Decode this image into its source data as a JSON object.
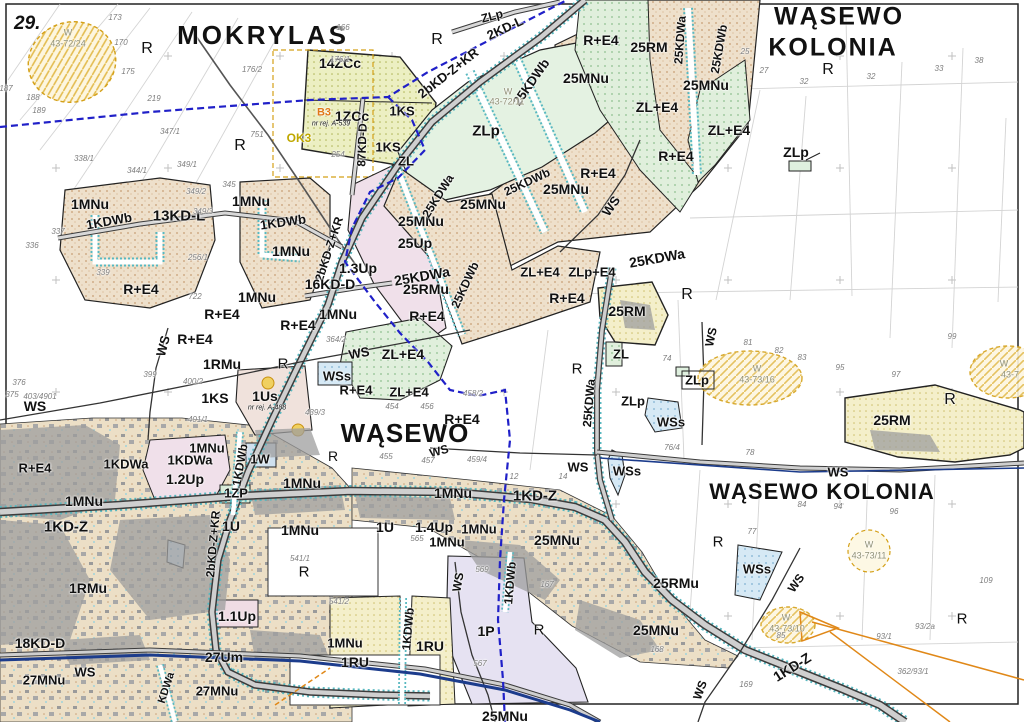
{
  "sheet": {
    "number": "29."
  },
  "colors": {
    "black": "#111111",
    "gray": "#7d7d7d",
    "site": "#8f8f74",
    "orange": "#e07818",
    "olive": "#bfa800",
    "tan_zone": "#eee0cb",
    "green_zone": "#e0efdc",
    "yellow_zone": "#f4efca",
    "blue_zone": "#d6e9f5",
    "water_navy": "#1c3c8c",
    "boundary_blue": "#2020c8",
    "teal_edge": "#58b8c0",
    "road_gray": "#cfcfcf"
  },
  "labels": [
    {
      "t": "MOKRYLAS",
      "x": 263,
      "y": 35,
      "s": 26,
      "ls": 3,
      "k": "place"
    },
    {
      "t": "WĄSEWO",
      "x": 839,
      "y": 17,
      "s": 25,
      "ls": 2,
      "k": "place"
    },
    {
      "t": "KOLONIA",
      "x": 833,
      "y": 48,
      "s": 25,
      "ls": 2,
      "k": "place"
    },
    {
      "t": "WĄSEWO",
      "x": 405,
      "y": 433,
      "s": 26,
      "ls": 1,
      "k": "place"
    },
    {
      "t": "WĄSEWO KOLONIA",
      "x": 822,
      "y": 492,
      "s": 22,
      "ls": 1,
      "k": "place"
    },
    {
      "t": "14ZCc",
      "x": 340,
      "y": 63,
      "s": 14
    },
    {
      "t": "1ZCc",
      "x": 352,
      "y": 116,
      "s": 14
    },
    {
      "t": "B3",
      "x": 324,
      "y": 113,
      "s": 11,
      "c": "orange"
    },
    {
      "t": "OK3",
      "x": 299,
      "y": 138,
      "s": 12,
      "c": "olive"
    },
    {
      "t": "nr rej. A-539",
      "x": 331,
      "y": 124,
      "s": 7,
      "w": "n",
      "i": true
    },
    {
      "t": "nr rej. A-488",
      "x": 267,
      "y": 408,
      "s": 7,
      "w": "n",
      "i": true
    },
    {
      "t": "1KS",
      "x": 402,
      "y": 111,
      "s": 13
    },
    {
      "t": "1KS",
      "x": 388,
      "y": 147,
      "s": 13
    },
    {
      "t": "87KD-D",
      "x": 362,
      "y": 145,
      "s": 12,
      "r": -88
    },
    {
      "t": "ZL",
      "x": 406,
      "y": 161,
      "s": 13
    },
    {
      "t": "ZLp",
      "x": 486,
      "y": 131,
      "s": 15
    },
    {
      "t": "2KD-L",
      "x": 505,
      "y": 28,
      "s": 13,
      "r": -25
    },
    {
      "t": "ZLp",
      "x": 492,
      "y": 16,
      "s": 12,
      "r": -15
    },
    {
      "t": "2bKD-Z+KR",
      "x": 448,
      "y": 73,
      "s": 13,
      "r": -38
    },
    {
      "t": "25KDWb",
      "x": 531,
      "y": 82,
      "s": 13,
      "r": -55
    },
    {
      "t": "25MNu",
      "x": 586,
      "y": 78,
      "s": 14
    },
    {
      "t": "R",
      "x": 437,
      "y": 40,
      "s": 16,
      "w": "n"
    },
    {
      "t": "R+E4",
      "x": 601,
      "y": 40,
      "s": 14
    },
    {
      "t": "25RM",
      "x": 649,
      "y": 47,
      "s": 14
    },
    {
      "t": "25KDWa",
      "x": 680,
      "y": 40,
      "s": 12,
      "r": -86
    },
    {
      "t": "25KDWb",
      "x": 719,
      "y": 49,
      "s": 12,
      "r": -80
    },
    {
      "t": "25MNu",
      "x": 706,
      "y": 85,
      "s": 14
    },
    {
      "t": "ZL+E4",
      "x": 657,
      "y": 107,
      "s": 14
    },
    {
      "t": "ZL+E4",
      "x": 729,
      "y": 130,
      "s": 14
    },
    {
      "t": "R+E4",
      "x": 676,
      "y": 156,
      "s": 14
    },
    {
      "t": "ZLp",
      "x": 796,
      "y": 152,
      "s": 14
    },
    {
      "t": "R",
      "x": 147,
      "y": 49,
      "s": 16,
      "w": "n"
    },
    {
      "t": "R",
      "x": 240,
      "y": 146,
      "s": 16,
      "w": "n"
    },
    {
      "t": "R",
      "x": 828,
      "y": 70,
      "s": 16,
      "w": "n"
    },
    {
      "t": "1MNu",
      "x": 90,
      "y": 204,
      "s": 14
    },
    {
      "t": "1KDWb",
      "x": 109,
      "y": 221,
      "s": 13,
      "r": -10
    },
    {
      "t": "13KD-L",
      "x": 179,
      "y": 216,
      "s": 15
    },
    {
      "t": "1MNu",
      "x": 251,
      "y": 201,
      "s": 14
    },
    {
      "t": "1KDWb",
      "x": 283,
      "y": 222,
      "s": 13,
      "r": -8
    },
    {
      "t": "1MNu",
      "x": 291,
      "y": 251,
      "s": 14
    },
    {
      "t": "2bKD-Z+KR",
      "x": 329,
      "y": 249,
      "s": 12,
      "r": -72
    },
    {
      "t": "1.3Up",
      "x": 358,
      "y": 268,
      "s": 14
    },
    {
      "t": "16KD-D",
      "x": 330,
      "y": 284,
      "s": 14
    },
    {
      "t": "1MNu",
      "x": 257,
      "y": 297,
      "s": 14
    },
    {
      "t": "1MNu",
      "x": 338,
      "y": 314,
      "s": 14
    },
    {
      "t": "R+E4",
      "x": 141,
      "y": 289,
      "s": 14
    },
    {
      "t": "R+E4",
      "x": 222,
      "y": 314,
      "s": 14
    },
    {
      "t": "R+E4",
      "x": 298,
      "y": 325,
      "s": 14
    },
    {
      "t": "R+E4",
      "x": 195,
      "y": 339,
      "s": 14
    },
    {
      "t": "WS",
      "x": 163,
      "y": 346,
      "s": 13,
      "r": -75
    },
    {
      "t": "25MNu",
      "x": 421,
      "y": 221,
      "s": 14
    },
    {
      "t": "25MNu",
      "x": 483,
      "y": 204,
      "s": 14
    },
    {
      "t": "25MNu",
      "x": 566,
      "y": 189,
      "s": 14
    },
    {
      "t": "25Up",
      "x": 415,
      "y": 243,
      "s": 14
    },
    {
      "t": "25KDWa",
      "x": 438,
      "y": 196,
      "s": 12,
      "r": -58
    },
    {
      "t": "25KDWa",
      "x": 422,
      "y": 276,
      "s": 14,
      "r": -10
    },
    {
      "t": "25RMu",
      "x": 426,
      "y": 289,
      "s": 14
    },
    {
      "t": "25KDWb",
      "x": 465,
      "y": 285,
      "s": 12,
      "r": -65
    },
    {
      "t": "25KDWb",
      "x": 527,
      "y": 182,
      "s": 12,
      "r": -25
    },
    {
      "t": "R+E4",
      "x": 427,
      "y": 316,
      "s": 14
    },
    {
      "t": "R+E4",
      "x": 598,
      "y": 173,
      "s": 14
    },
    {
      "t": "WS",
      "x": 611,
      "y": 206,
      "s": 13,
      "r": -55
    },
    {
      "t": "25KDWa",
      "x": 657,
      "y": 258,
      "s": 14,
      "r": -10
    },
    {
      "t": "ZL+E4",
      "x": 540,
      "y": 272,
      "s": 13
    },
    {
      "t": "ZLp+E4",
      "x": 592,
      "y": 272,
      "s": 13
    },
    {
      "t": "R+E4",
      "x": 567,
      "y": 298,
      "s": 14
    },
    {
      "t": "25RM",
      "x": 627,
      "y": 311,
      "s": 14
    },
    {
      "t": "R",
      "x": 687,
      "y": 295,
      "s": 16,
      "w": "n"
    },
    {
      "t": "ZL",
      "x": 621,
      "y": 354,
      "s": 13
    },
    {
      "t": "R",
      "x": 577,
      "y": 369,
      "s": 15,
      "w": "n"
    },
    {
      "t": "ZLp",
      "x": 697,
      "y": 380,
      "s": 13
    },
    {
      "t": "ZLp",
      "x": 633,
      "y": 401,
      "s": 13
    },
    {
      "t": "WS",
      "x": 711,
      "y": 337,
      "s": 12,
      "r": -78
    },
    {
      "t": "1RMu",
      "x": 222,
      "y": 364,
      "s": 14
    },
    {
      "t": "R",
      "x": 283,
      "y": 364,
      "s": 15,
      "w": "n"
    },
    {
      "t": "WS",
      "x": 359,
      "y": 353,
      "s": 13,
      "r": -10
    },
    {
      "t": "ZL+E4",
      "x": 403,
      "y": 354,
      "s": 14
    },
    {
      "t": "WSs",
      "x": 337,
      "y": 376,
      "s": 13
    },
    {
      "t": "R+E4",
      "x": 356,
      "y": 390,
      "s": 13
    },
    {
      "t": "ZL+E4",
      "x": 409,
      "y": 392,
      "s": 13
    },
    {
      "t": "1KS",
      "x": 215,
      "y": 398,
      "s": 14
    },
    {
      "t": "1Us",
      "x": 265,
      "y": 396,
      "s": 14
    },
    {
      "t": "WS",
      "x": 35,
      "y": 406,
      "s": 14
    },
    {
      "t": "R+E4",
      "x": 35,
      "y": 468,
      "s": 13
    },
    {
      "t": "R+E4",
      "x": 462,
      "y": 419,
      "s": 14
    },
    {
      "t": "WS",
      "x": 439,
      "y": 451,
      "s": 12,
      "r": -15
    },
    {
      "t": "1MNu",
      "x": 84,
      "y": 501,
      "s": 14
    },
    {
      "t": "1KD-Z",
      "x": 66,
      "y": 527,
      "s": 15
    },
    {
      "t": "1KDWa",
      "x": 126,
      "y": 464,
      "s": 13
    },
    {
      "t": "1KDWa",
      "x": 190,
      "y": 460,
      "s": 13
    },
    {
      "t": "1.2Up",
      "x": 185,
      "y": 479,
      "s": 14
    },
    {
      "t": "1MNu",
      "x": 207,
      "y": 448,
      "s": 13
    },
    {
      "t": "1W",
      "x": 260,
      "y": 459,
      "s": 13
    },
    {
      "t": "1KDWb",
      "x": 240,
      "y": 465,
      "s": 12,
      "r": -80
    },
    {
      "t": "1ZP",
      "x": 236,
      "y": 493,
      "s": 13
    },
    {
      "t": "2bKD-Z+KR",
      "x": 213,
      "y": 544,
      "s": 12,
      "r": -85
    },
    {
      "t": "1U",
      "x": 231,
      "y": 526,
      "s": 14
    },
    {
      "t": "1MNu",
      "x": 302,
      "y": 483,
      "s": 14
    },
    {
      "t": "1MNu",
      "x": 300,
      "y": 530,
      "s": 14
    },
    {
      "t": "R",
      "x": 333,
      "y": 456,
      "s": 14,
      "w": "n"
    },
    {
      "t": "R",
      "x": 304,
      "y": 572,
      "s": 15,
      "w": "n"
    },
    {
      "t": "1MNu",
      "x": 453,
      "y": 493,
      "s": 14
    },
    {
      "t": "1KD-Z",
      "x": 535,
      "y": 496,
      "s": 15
    },
    {
      "t": "WS",
      "x": 578,
      "y": 467,
      "s": 13
    },
    {
      "t": "WSs",
      "x": 627,
      "y": 471,
      "s": 13
    },
    {
      "t": "WSs",
      "x": 671,
      "y": 422,
      "s": 13
    },
    {
      "t": "25KDWa",
      "x": 589,
      "y": 403,
      "s": 12,
      "r": -85
    },
    {
      "t": "1U",
      "x": 385,
      "y": 527,
      "s": 14
    },
    {
      "t": "1.4Up",
      "x": 434,
      "y": 527,
      "s": 14
    },
    {
      "t": "1MNu",
      "x": 479,
      "y": 529,
      "s": 13
    },
    {
      "t": "1MNu",
      "x": 447,
      "y": 542,
      "s": 13
    },
    {
      "t": "25MNu",
      "x": 557,
      "y": 540,
      "s": 14
    },
    {
      "t": "1KDWb",
      "x": 510,
      "y": 583,
      "s": 12,
      "r": -85
    },
    {
      "t": "WS",
      "x": 458,
      "y": 582,
      "s": 12,
      "r": -80
    },
    {
      "t": "1KDWb",
      "x": 408,
      "y": 629,
      "s": 12,
      "r": -85
    },
    {
      "t": "1P",
      "x": 486,
      "y": 631,
      "s": 14
    },
    {
      "t": "R",
      "x": 539,
      "y": 630,
      "s": 15,
      "w": "n"
    },
    {
      "t": "1RU",
      "x": 430,
      "y": 646,
      "s": 14
    },
    {
      "t": "1RU",
      "x": 355,
      "y": 662,
      "s": 14
    },
    {
      "t": "1MNu",
      "x": 345,
      "y": 643,
      "s": 13
    },
    {
      "t": "25MNu",
      "x": 505,
      "y": 716,
      "s": 14
    },
    {
      "t": "25RMu",
      "x": 676,
      "y": 583,
      "s": 14
    },
    {
      "t": "25MNu",
      "x": 656,
      "y": 630,
      "s": 14
    },
    {
      "t": "WSs",
      "x": 757,
      "y": 569,
      "s": 13
    },
    {
      "t": "WS",
      "x": 796,
      "y": 583,
      "s": 12,
      "r": -55
    },
    {
      "t": "R",
      "x": 718,
      "y": 542,
      "s": 15,
      "w": "n"
    },
    {
      "t": "R",
      "x": 962,
      "y": 619,
      "s": 15,
      "w": "n"
    },
    {
      "t": "R",
      "x": 950,
      "y": 400,
      "s": 16,
      "w": "n"
    },
    {
      "t": "25RM",
      "x": 892,
      "y": 420,
      "s": 14
    },
    {
      "t": "WS",
      "x": 838,
      "y": 472,
      "s": 13
    },
    {
      "t": "1KD-Z",
      "x": 792,
      "y": 667,
      "s": 14,
      "r": -32
    },
    {
      "t": "WS",
      "x": 700,
      "y": 690,
      "s": 12,
      "r": -70
    },
    {
      "t": "18KD-D",
      "x": 40,
      "y": 643,
      "s": 14
    },
    {
      "t": "27Um",
      "x": 224,
      "y": 657,
      "s": 14
    },
    {
      "t": "WS",
      "x": 85,
      "y": 672,
      "s": 13
    },
    {
      "t": "27MNu",
      "x": 44,
      "y": 680,
      "s": 13
    },
    {
      "t": "27MNu",
      "x": 217,
      "y": 691,
      "s": 13
    },
    {
      "t": "KDWa",
      "x": 167,
      "y": 688,
      "s": 11,
      "r": -72
    },
    {
      "t": "1RMu",
      "x": 88,
      "y": 588,
      "s": 14
    },
    {
      "t": "1.1Up",
      "x": 237,
      "y": 616,
      "s": 14
    },
    {
      "t": "W",
      "x": 68,
      "y": 33,
      "s": 9,
      "w": "n",
      "c": "site",
      "k": "site"
    },
    {
      "t": "43-72/24",
      "x": 68,
      "y": 44,
      "s": 9,
      "w": "n",
      "c": "site",
      "k": "site"
    },
    {
      "t": "W",
      "x": 508,
      "y": 92,
      "s": 9,
      "w": "n",
      "c": "site",
      "k": "site"
    },
    {
      "t": "43-72/11",
      "x": 507,
      "y": 102,
      "s": 9,
      "w": "n",
      "c": "site",
      "k": "site"
    },
    {
      "t": "W",
      "x": 757,
      "y": 369,
      "s": 9,
      "w": "n",
      "c": "site",
      "k": "site"
    },
    {
      "t": "43-73/16",
      "x": 757,
      "y": 380,
      "s": 9,
      "w": "n",
      "c": "site",
      "k": "site"
    },
    {
      "t": "W",
      "x": 869,
      "y": 545,
      "s": 9,
      "w": "n",
      "c": "site",
      "k": "site"
    },
    {
      "t": "43-73/11",
      "x": 869,
      "y": 556,
      "s": 9,
      "w": "n",
      "c": "site",
      "k": "site"
    },
    {
      "t": "W",
      "x": 786,
      "y": 618,
      "s": 9,
      "w": "n",
      "c": "site",
      "k": "site"
    },
    {
      "t": "43-73/10",
      "x": 787,
      "y": 629,
      "s": 9,
      "w": "n",
      "c": "site",
      "k": "site"
    },
    {
      "t": "W",
      "x": 1004,
      "y": 364,
      "s": 9,
      "w": "n",
      "c": "site",
      "k": "site"
    },
    {
      "t": "43-7",
      "x": 1010,
      "y": 375,
      "s": 9,
      "w": "n",
      "c": "site",
      "k": "site"
    },
    {
      "t": "173",
      "x": 115,
      "y": 18,
      "k": "parcel"
    },
    {
      "t": "166",
      "x": 343,
      "y": 28,
      "k": "parcel"
    },
    {
      "t": "170",
      "x": 121,
      "y": 43,
      "k": "parcel"
    },
    {
      "t": "176/1",
      "x": 340,
      "y": 60,
      "k": "parcel"
    },
    {
      "t": "176/2",
      "x": 252,
      "y": 70,
      "k": "parcel"
    },
    {
      "t": "175",
      "x": 128,
      "y": 72,
      "k": "parcel"
    },
    {
      "t": "187",
      "x": 6,
      "y": 89,
      "k": "parcel"
    },
    {
      "t": "188",
      "x": 33,
      "y": 98,
      "k": "parcel"
    },
    {
      "t": "189",
      "x": 39,
      "y": 111,
      "k": "parcel"
    },
    {
      "t": "219",
      "x": 154,
      "y": 99,
      "k": "parcel"
    },
    {
      "t": "347/1",
      "x": 170,
      "y": 132,
      "k": "parcel"
    },
    {
      "t": "751",
      "x": 257,
      "y": 135,
      "k": "parcel"
    },
    {
      "t": "254",
      "x": 338,
      "y": 155,
      "k": "parcel"
    },
    {
      "t": "338/1",
      "x": 84,
      "y": 159,
      "k": "parcel"
    },
    {
      "t": "344/1",
      "x": 137,
      "y": 171,
      "k": "parcel"
    },
    {
      "t": "349/1",
      "x": 187,
      "y": 165,
      "k": "parcel"
    },
    {
      "t": "345",
      "x": 229,
      "y": 185,
      "k": "parcel"
    },
    {
      "t": "349/2",
      "x": 196,
      "y": 192,
      "k": "parcel"
    },
    {
      "t": "349/3",
      "x": 203,
      "y": 212,
      "k": "parcel"
    },
    {
      "t": "337",
      "x": 58,
      "y": 232,
      "k": "parcel"
    },
    {
      "t": "336",
      "x": 32,
      "y": 246,
      "k": "parcel"
    },
    {
      "t": "339",
      "x": 103,
      "y": 273,
      "k": "parcel"
    },
    {
      "t": "256/1",
      "x": 198,
      "y": 258,
      "k": "parcel"
    },
    {
      "t": "722",
      "x": 195,
      "y": 297,
      "k": "parcel"
    },
    {
      "t": "25",
      "x": 745,
      "y": 52,
      "k": "parcel"
    },
    {
      "t": "27",
      "x": 764,
      "y": 71,
      "k": "parcel"
    },
    {
      "t": "32",
      "x": 804,
      "y": 82,
      "k": "parcel"
    },
    {
      "t": "32",
      "x": 871,
      "y": 77,
      "k": "parcel"
    },
    {
      "t": "33",
      "x": 939,
      "y": 69,
      "k": "parcel"
    },
    {
      "t": "38",
      "x": 979,
      "y": 61,
      "k": "parcel"
    },
    {
      "t": "74",
      "x": 667,
      "y": 359,
      "k": "parcel"
    },
    {
      "t": "81",
      "x": 748,
      "y": 343,
      "k": "parcel"
    },
    {
      "t": "82",
      "x": 779,
      "y": 351,
      "k": "parcel"
    },
    {
      "t": "83",
      "x": 802,
      "y": 358,
      "k": "parcel"
    },
    {
      "t": "95",
      "x": 840,
      "y": 368,
      "k": "parcel"
    },
    {
      "t": "97",
      "x": 896,
      "y": 375,
      "k": "parcel"
    },
    {
      "t": "99",
      "x": 952,
      "y": 337,
      "k": "parcel"
    },
    {
      "t": "76/4",
      "x": 672,
      "y": 448,
      "k": "parcel"
    },
    {
      "t": "78",
      "x": 750,
      "y": 453,
      "k": "parcel"
    },
    {
      "t": "77",
      "x": 752,
      "y": 532,
      "k": "parcel"
    },
    {
      "t": "84",
      "x": 802,
      "y": 505,
      "k": "parcel"
    },
    {
      "t": "94",
      "x": 838,
      "y": 507,
      "k": "parcel"
    },
    {
      "t": "96",
      "x": 894,
      "y": 512,
      "k": "parcel"
    },
    {
      "t": "109",
      "x": 986,
      "y": 581,
      "k": "parcel"
    },
    {
      "t": "93/2a",
      "x": 925,
      "y": 627,
      "k": "parcel"
    },
    {
      "t": "93/1",
      "x": 884,
      "y": 637,
      "k": "parcel"
    },
    {
      "t": "362/93/1",
      "x": 913,
      "y": 672,
      "k": "parcel"
    },
    {
      "t": "169",
      "x": 746,
      "y": 685,
      "k": "parcel"
    },
    {
      "t": "375",
      "x": 12,
      "y": 395,
      "k": "parcel"
    },
    {
      "t": "376",
      "x": 19,
      "y": 383,
      "k": "parcel"
    },
    {
      "t": "399",
      "x": 150,
      "y": 375,
      "k": "parcel"
    },
    {
      "t": "400/2",
      "x": 193,
      "y": 382,
      "k": "parcel"
    },
    {
      "t": "401/1",
      "x": 198,
      "y": 420,
      "k": "parcel"
    },
    {
      "t": "403/4901",
      "x": 40,
      "y": 397,
      "k": "parcel"
    },
    {
      "t": "439/3",
      "x": 315,
      "y": 413,
      "k": "parcel"
    },
    {
      "t": "364/2",
      "x": 336,
      "y": 340,
      "k": "parcel"
    },
    {
      "t": "454",
      "x": 392,
      "y": 407,
      "k": "parcel"
    },
    {
      "t": "456",
      "x": 427,
      "y": 407,
      "k": "parcel"
    },
    {
      "t": "455",
      "x": 386,
      "y": 457,
      "k": "parcel"
    },
    {
      "t": "457",
      "x": 428,
      "y": 461,
      "k": "parcel"
    },
    {
      "t": "459/4",
      "x": 477,
      "y": 460,
      "k": "parcel"
    },
    {
      "t": "458/2",
      "x": 473,
      "y": 394,
      "k": "parcel"
    },
    {
      "t": "14",
      "x": 563,
      "y": 477,
      "k": "parcel"
    },
    {
      "t": "12",
      "x": 514,
      "y": 477,
      "k": "parcel"
    },
    {
      "t": "541/1",
      "x": 300,
      "y": 559,
      "k": "parcel"
    },
    {
      "t": "541/2",
      "x": 339,
      "y": 602,
      "k": "parcel"
    },
    {
      "t": "565",
      "x": 417,
      "y": 539,
      "k": "parcel"
    },
    {
      "t": "567",
      "x": 480,
      "y": 664,
      "k": "parcel"
    },
    {
      "t": "569",
      "x": 482,
      "y": 570,
      "k": "parcel"
    },
    {
      "t": "167",
      "x": 547,
      "y": 585,
      "k": "parcel"
    },
    {
      "t": "168",
      "x": 657,
      "y": 650,
      "k": "parcel"
    },
    {
      "t": "85",
      "x": 781,
      "y": 636,
      "k": "parcel"
    }
  ]
}
